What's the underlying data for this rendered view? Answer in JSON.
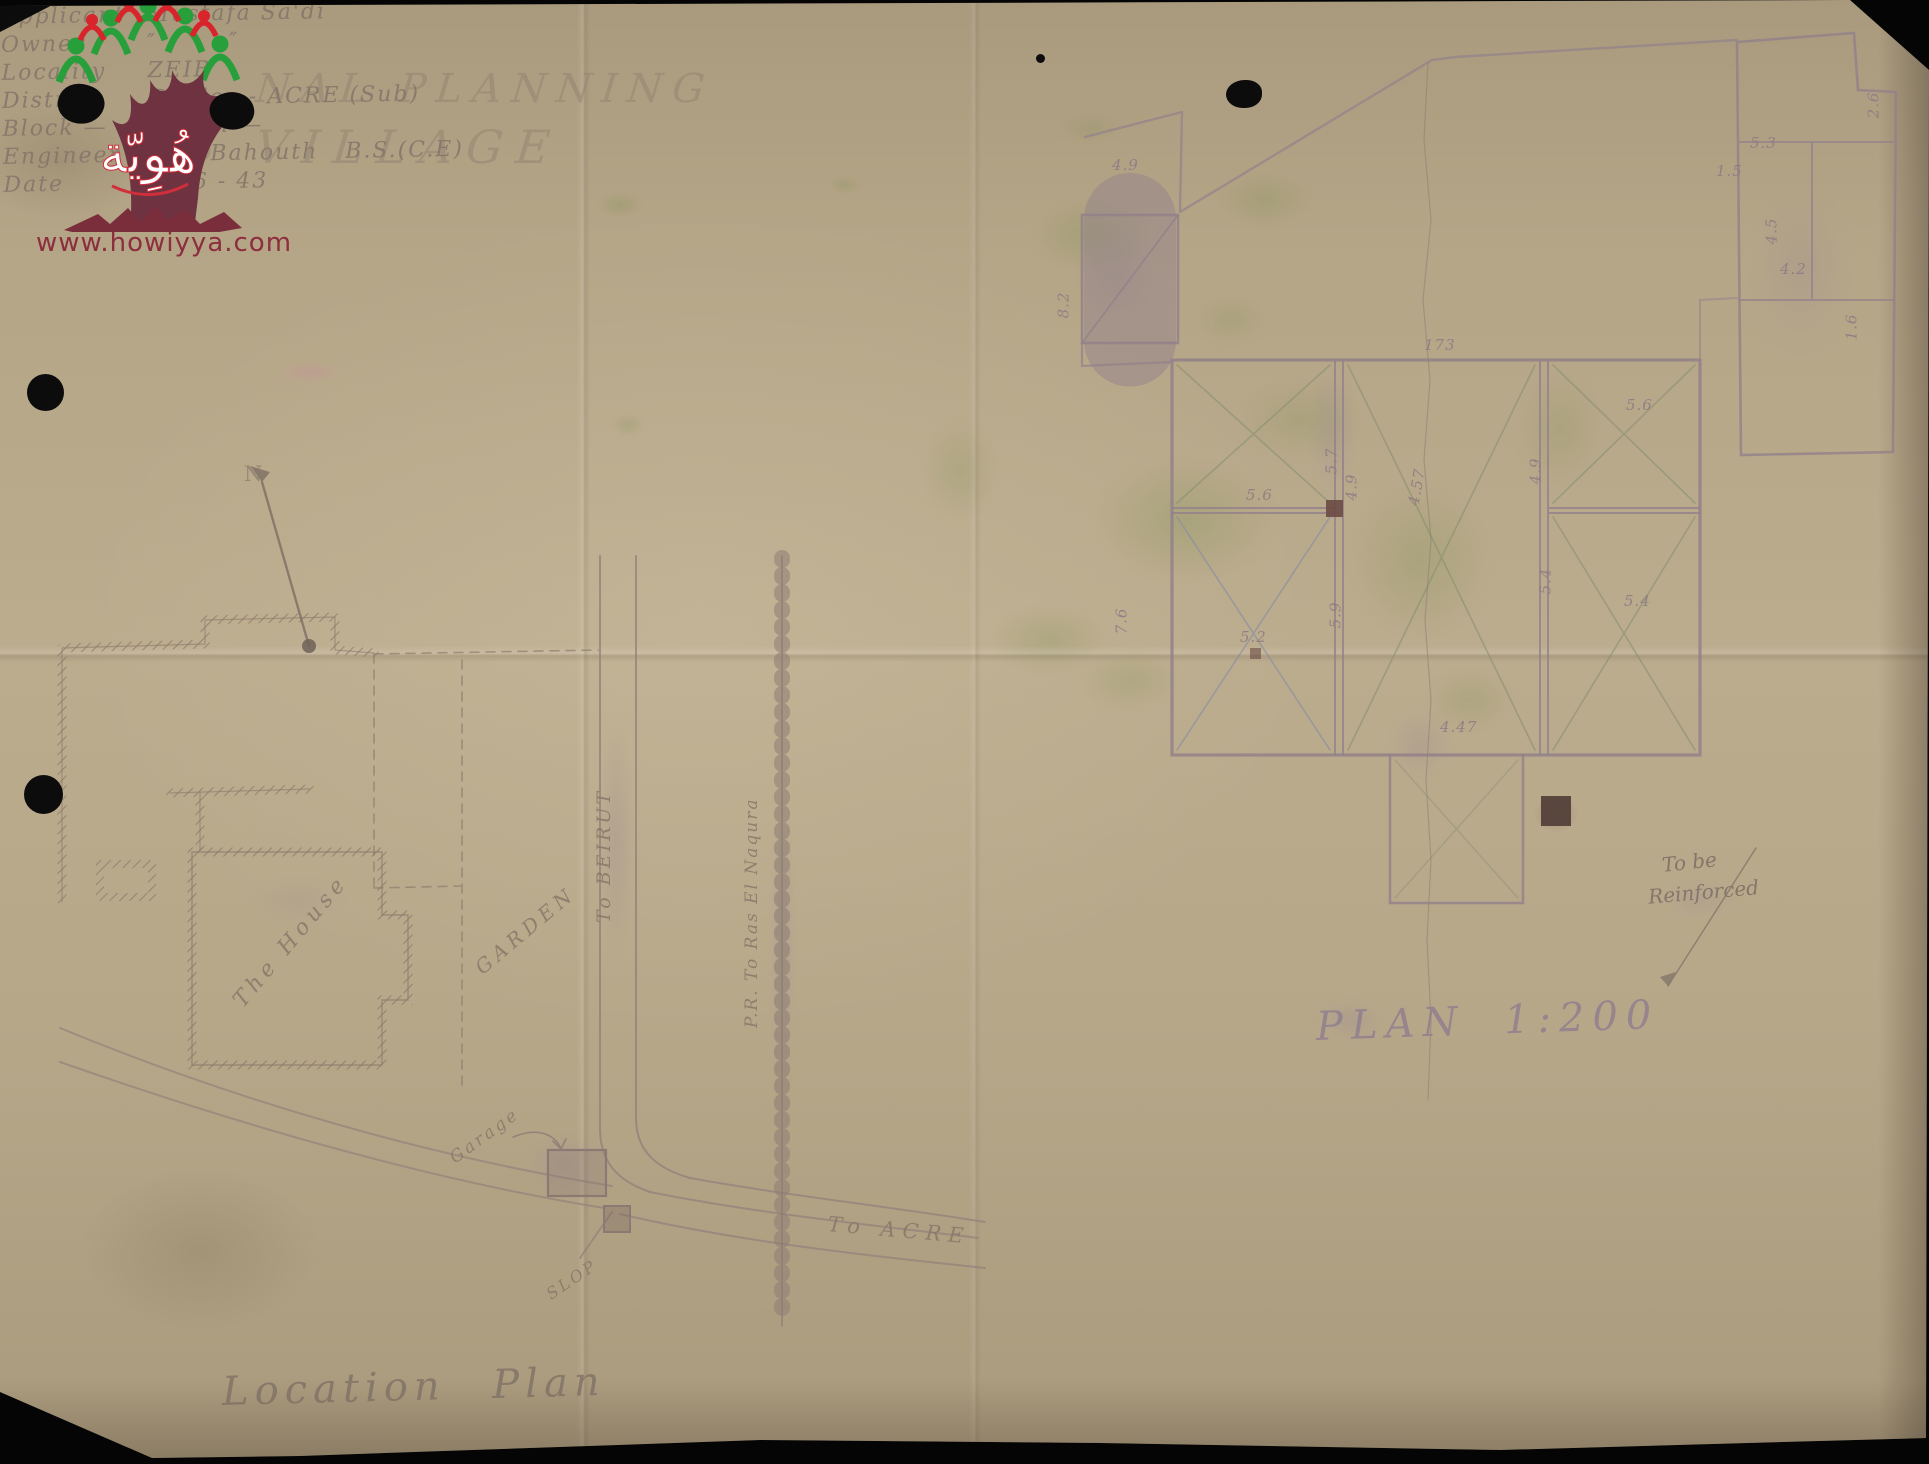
{
  "watermark": {
    "url_text": "www.howiyya.com",
    "brand_arabic": "هُوِيّة"
  },
  "header": {
    "title_line1": "NAL PLANNING",
    "title_line2": "IB VILLAGE"
  },
  "info": {
    "rows": [
      {
        "label": "Applicant",
        "value": "Mustafa Sa'di"
      },
      {
        "label": "Owner",
        "value": "″        ″"
      },
      {
        "label": "Locality",
        "value": "ZEIB"
      },
      {
        "label": "District",
        "value": "Galilee - ACRE (Sub)"
      },
      {
        "label": "Block —",
        "value": "Parcel —"
      },
      {
        "label": "Engineer",
        "value": "B.S. Bahouth   B.S.(C.E)"
      },
      {
        "label": "Date",
        "value": "1 - 6 - 43"
      }
    ]
  },
  "location_plan": {
    "title": "Location Plan",
    "labels": {
      "north": "N",
      "house": "The House",
      "garden": "GARDEN",
      "garage": "Garage",
      "slope": "SLOP",
      "road_to_beirut": "To BEIRUT",
      "road_to_acre": "To ACRE",
      "railway": "P.R. To Ras El Naqura"
    }
  },
  "floor_plan": {
    "title": "PLAN 1:200",
    "note": {
      "line1": "To be",
      "line2": "Reinforced"
    },
    "dims": [
      {
        "t": "4.9",
        "x": 1112,
        "y": 156,
        "r": 0
      },
      {
        "t": "8.2",
        "x": 1050,
        "y": 296,
        "r": -90
      },
      {
        "t": "173",
        "x": 1424,
        "y": 336,
        "r": 0
      },
      {
        "t": "5.6",
        "x": 1246,
        "y": 486,
        "r": 0
      },
      {
        "t": "5.6",
        "x": 1626,
        "y": 396,
        "r": 0
      },
      {
        "t": "5.7",
        "x": 1318,
        "y": 452,
        "r": -90
      },
      {
        "t": "4.9",
        "x": 1338,
        "y": 478,
        "r": -90
      },
      {
        "t": "4.57",
        "x": 1398,
        "y": 478,
        "r": -80
      },
      {
        "t": "4.9",
        "x": 1522,
        "y": 462,
        "r": -90
      },
      {
        "t": "5.2",
        "x": 1240,
        "y": 628,
        "r": 0
      },
      {
        "t": "5.9",
        "x": 1322,
        "y": 606,
        "r": -90
      },
      {
        "t": "5.4",
        "x": 1532,
        "y": 572,
        "r": -90
      },
      {
        "t": "5.4",
        "x": 1624,
        "y": 592,
        "r": 0
      },
      {
        "t": "4.47",
        "x": 1440,
        "y": 718,
        "r": 0
      },
      {
        "t": "7.6",
        "x": 1108,
        "y": 612,
        "r": -90
      },
      {
        "t": "5.3",
        "x": 1750,
        "y": 134,
        "r": 0
      },
      {
        "t": "1.5",
        "x": 1716,
        "y": 162,
        "r": 0
      },
      {
        "t": "4.5",
        "x": 1758,
        "y": 222,
        "r": -90
      },
      {
        "t": "4.2",
        "x": 1780,
        "y": 260,
        "r": 0
      },
      {
        "t": "1.6",
        "x": 1838,
        "y": 318,
        "r": -90
      },
      {
        "t": "2.6",
        "x": 1860,
        "y": 96,
        "r": -90
      }
    ]
  },
  "colors": {
    "paper": "#b5a587",
    "pencil": "#84776a",
    "plan_ink": "#92818a",
    "logo_red": "#8c2e3e",
    "logo_green": "#27a03c",
    "tint_green": "#7e8f52"
  }
}
